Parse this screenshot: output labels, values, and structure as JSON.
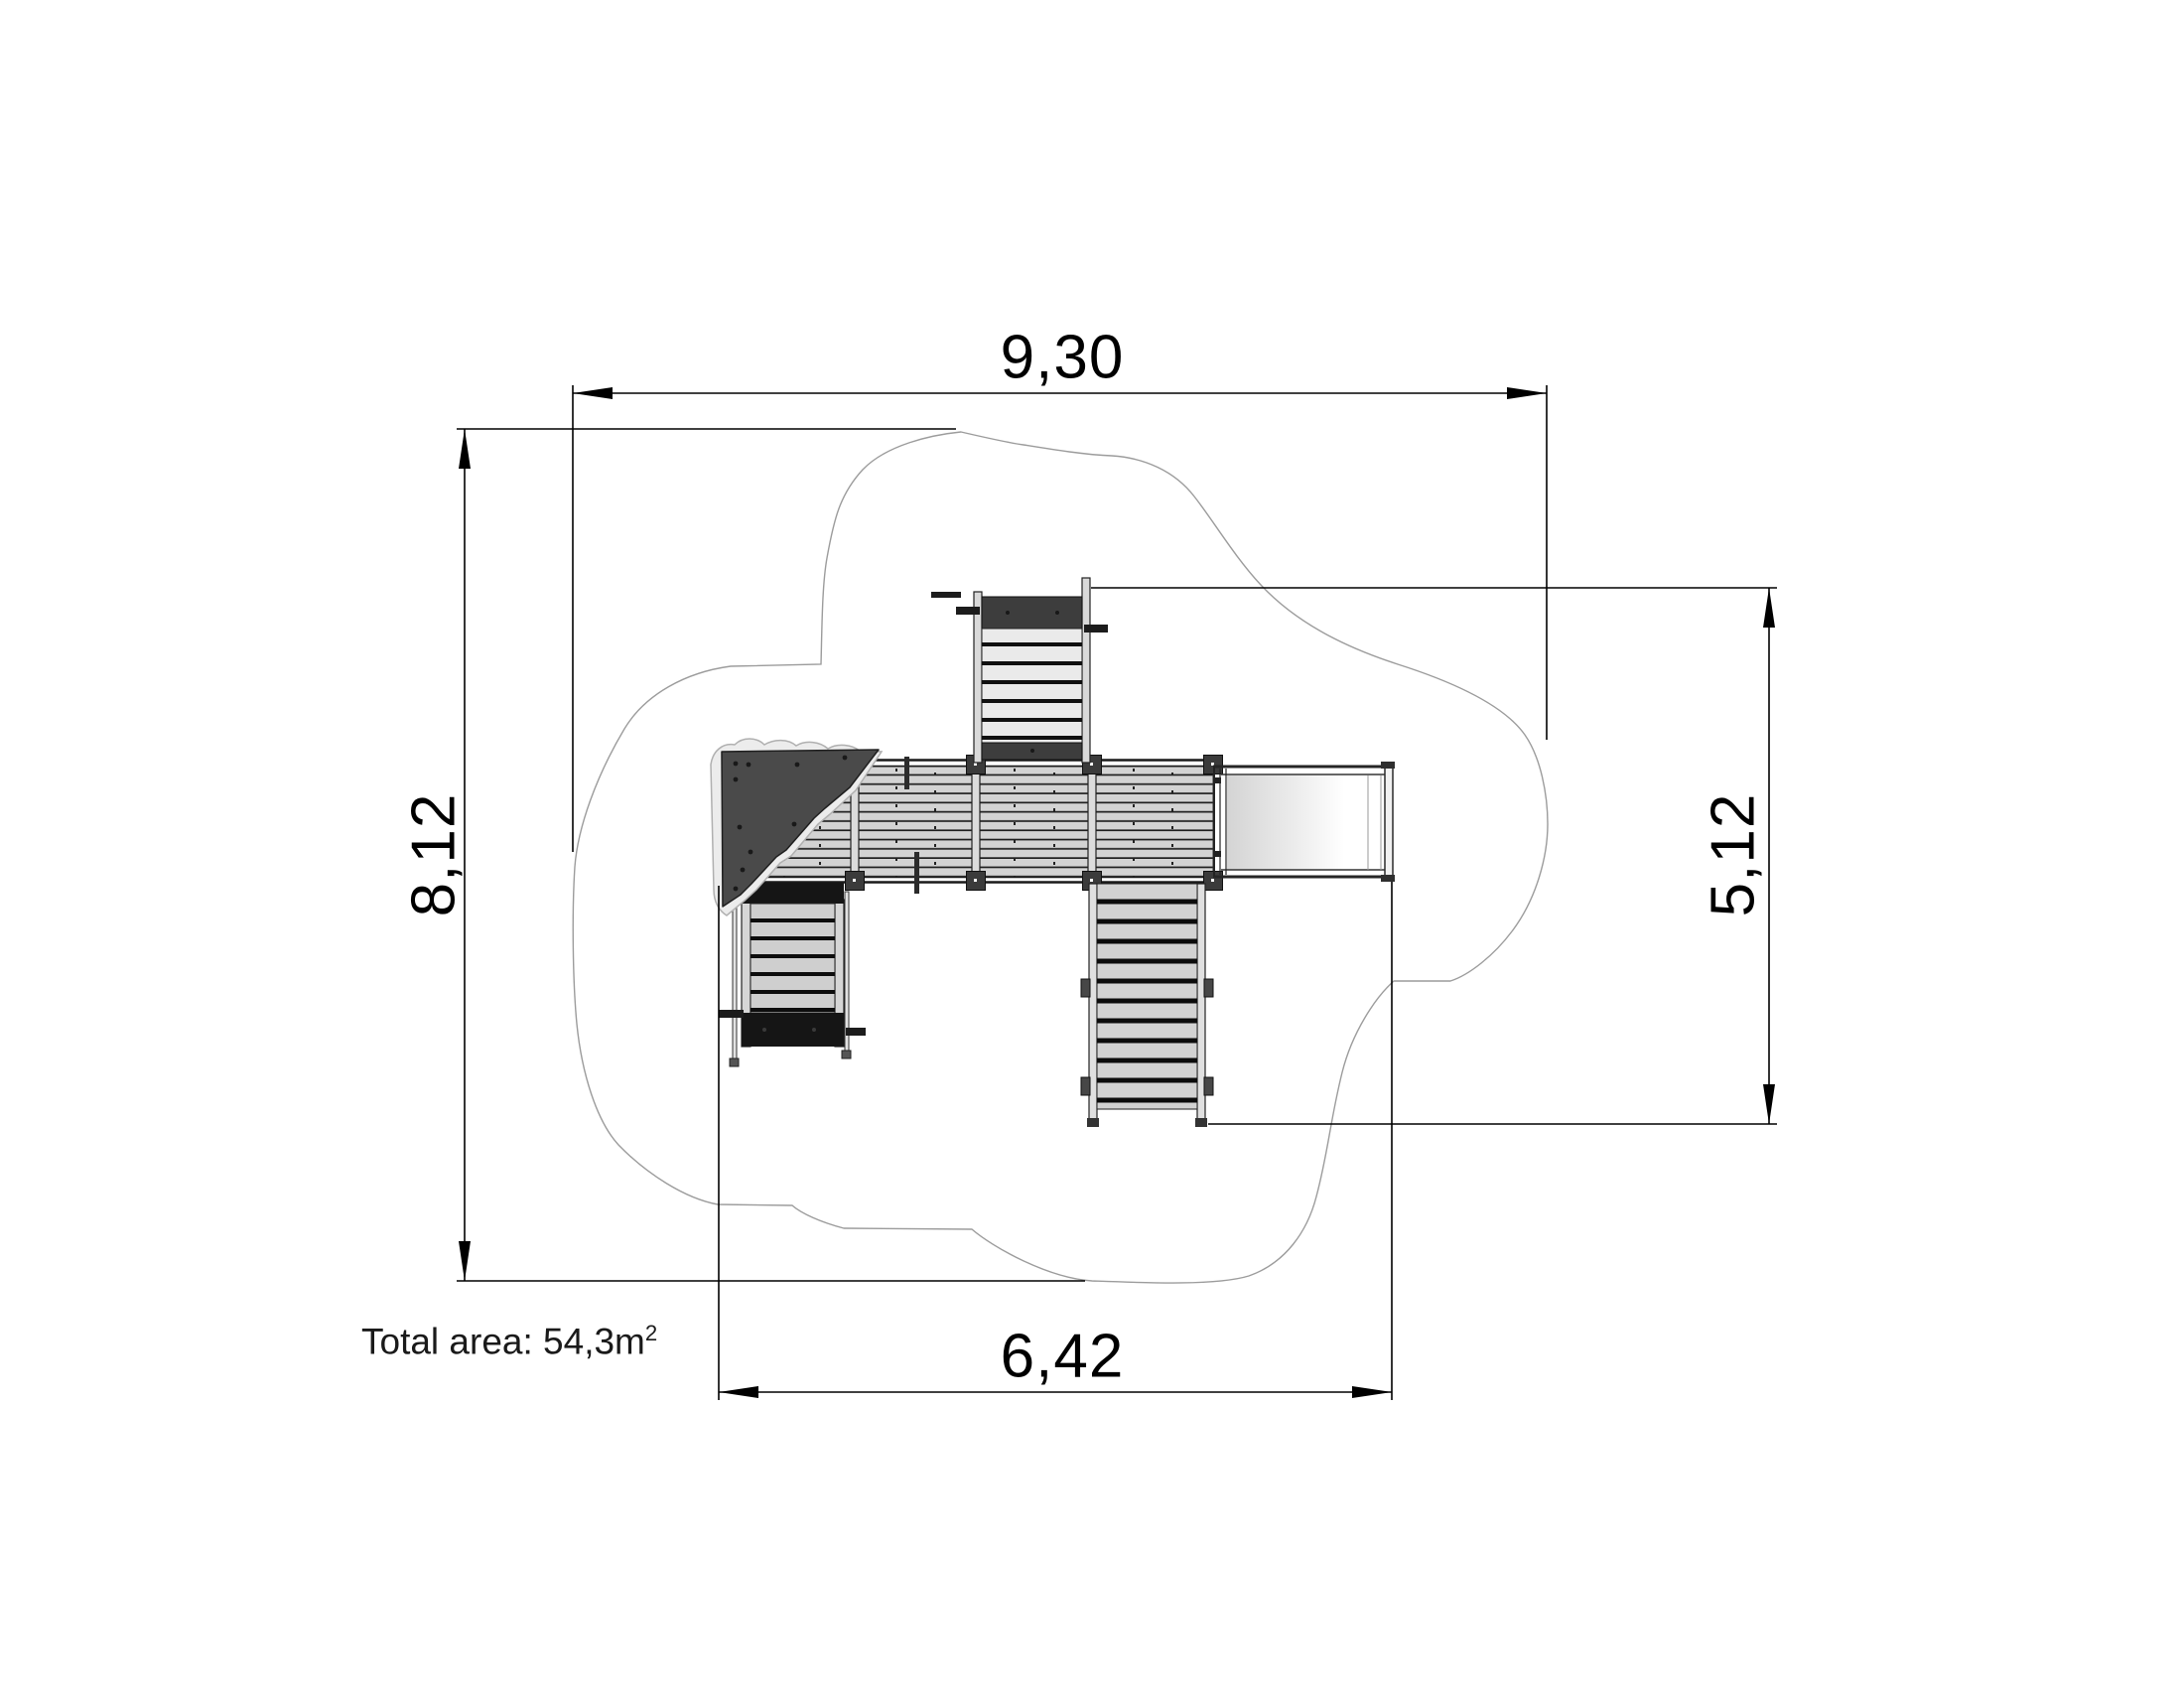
{
  "dimensions": {
    "top": {
      "label": "9,30",
      "orientation": "horizontal",
      "measures": "overall safety zone width (m)"
    },
    "left": {
      "label": "8,12",
      "orientation": "vertical",
      "measures": "overall safety zone depth (m)"
    },
    "right": {
      "label": "5,12",
      "orientation": "vertical",
      "measures": "equipment extent depth (m)"
    },
    "bottom": {
      "label": "6,42",
      "orientation": "horizontal",
      "measures": "equipment extent width (m)"
    }
  },
  "total_area": {
    "text": "Total area: 54,3m",
    "superscript": "2"
  },
  "palette": {
    "dimension_lines": "#000000",
    "safety_zone_outline": "#9c9c9c",
    "deck_plank": "#d3d3d3",
    "plank_gap": "#1f1f1f",
    "climbing_wall": "#4a4a4a",
    "ladder_band_dark": "#3d3d3d",
    "ladder_band_black": "#151515",
    "tread_light": "#eaeaea",
    "slide_bed_start": "#d4d4d4",
    "slide_bed_end": "#ffffff"
  }
}
